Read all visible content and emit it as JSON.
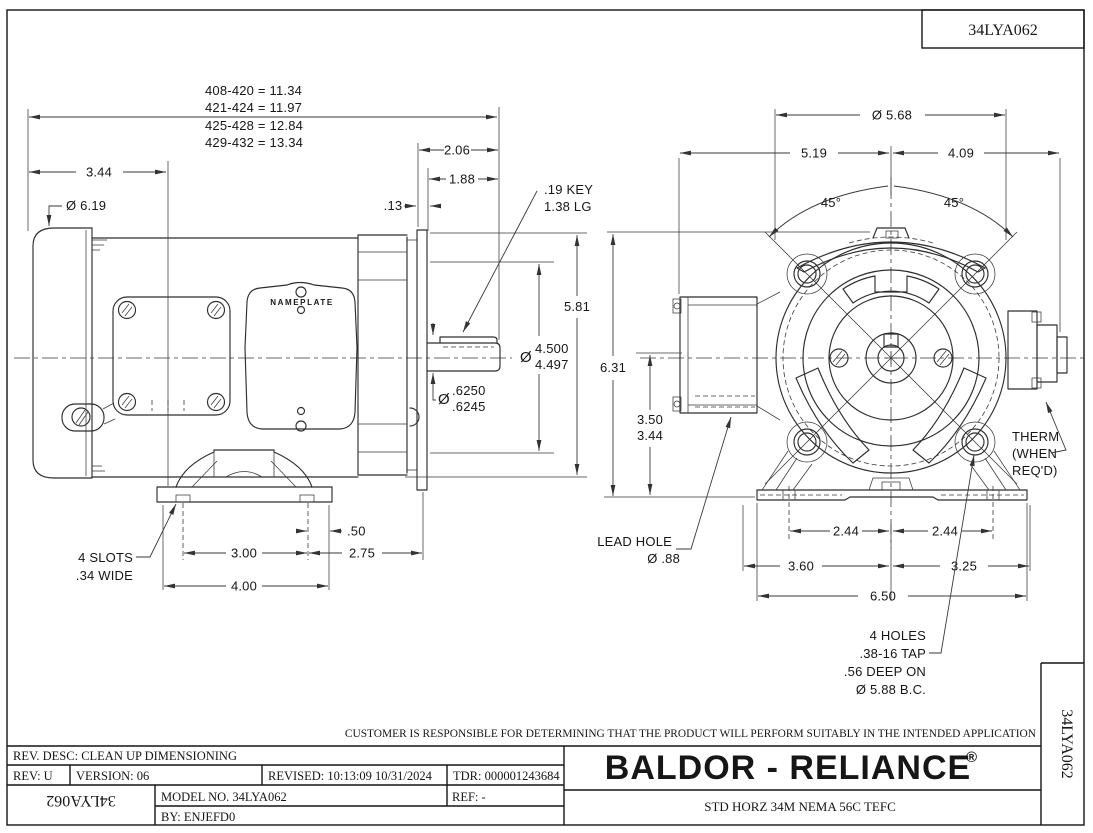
{
  "page": {
    "code_top": "34LYA062",
    "code_right": "34LYA062",
    "code_left_inverted": "34LYA062",
    "disclaimer": "CUSTOMER IS RESPONSIBLE FOR DETERMINING THAT THE PRODUCT WILL PERFORM SUITABLY IN THE INTENDED APPLICATION"
  },
  "title_block": {
    "rev_desc": "REV. DESC: CLEAN UP DIMENSIONING",
    "rev": "REV:  U",
    "version": "VERSION: 06",
    "revised": "REVISED: 10:13:09 10/31/2024",
    "tdr": "TDR: 000001243684",
    "model_no": "MODEL NO.  34LYA062",
    "by": "BY:    ENJEFD0",
    "ref": "REF:  -",
    "brand": "BALDOR - RELIANCE",
    "registered": "®",
    "description": "STD HORZ 34M NEMA 56C TEFC"
  },
  "side_view": {
    "nameplate_label": "NAMEPLATE",
    "length_table": [
      "408-420 = 11.34",
      "421-424 = 11.97",
      "425-428 = 12.84",
      "429-432 = 13.34"
    ],
    "dims": {
      "rear_to_face": "3.44",
      "fan_dia": "Ø 6.19",
      "shaft_ext": "2.06",
      "shaft_usable": "1.88",
      "key_start": ".13",
      "key_note_line1": ".19 KEY",
      "key_note_line2": "1.38 LG",
      "flange_height": "5.81",
      "pilot_sym": "Ø",
      "pilot_upper": "4.500",
      "pilot_lower": "4.497",
      "shaft_sym": "Ø",
      "shaft_upper": ".6250",
      "shaft_lower": ".6245",
      "slot_to_edge": ".50",
      "foot_spacing": "3.00",
      "foot_to_flange": "2.75",
      "base_length": "4.00",
      "slots_note_line1": "4 SLOTS",
      "slots_note_line2": ".34 WIDE"
    }
  },
  "front_view": {
    "dims": {
      "outer_dia": "Ø 5.68",
      "width_left": "5.19",
      "width_right": "4.09",
      "angle_left": "45°",
      "angle_right": "45°",
      "overall_height": "6.31",
      "shaft_height_upper": "3.50",
      "shaft_height_lower": "3.44",
      "lead_hole_line1": "LEAD HOLE",
      "lead_hole_line2": "Ø .88",
      "foot_half_left": "2.44",
      "foot_half_right": "2.44",
      "base_left": "3.60",
      "base_right": "3.25",
      "base_width": "6.50",
      "holes_note_line1": "4 HOLES",
      "holes_note_line2": ".38-16 TAP",
      "holes_note_line3": ".56 DEEP ON",
      "holes_note_line4": "Ø 5.88 B.C.",
      "therm_note_line1": "THERM",
      "therm_note_line2": "(WHEN",
      "therm_note_line3": "REQ'D)"
    }
  }
}
